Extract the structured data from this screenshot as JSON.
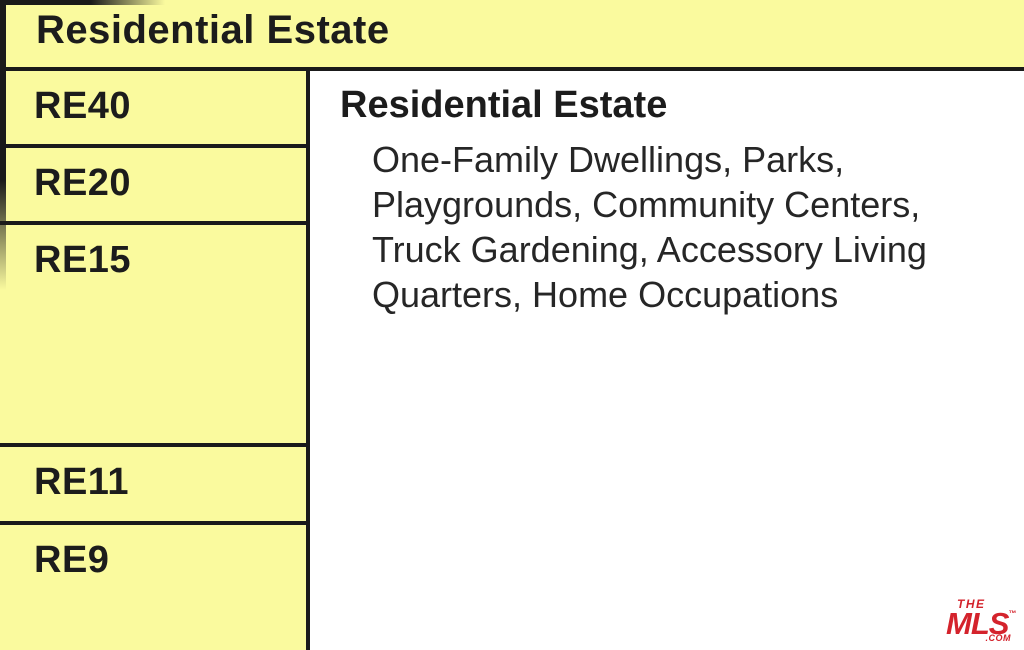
{
  "header": {
    "title": "Residential Estate"
  },
  "zones": {
    "codes": [
      "RE40",
      "RE20",
      "RE15",
      "RE11",
      "RE9"
    ]
  },
  "detail": {
    "heading": "Residential Estate",
    "description_lines": [
      "One-Family Dwellings, Parks,",
      "Playgrounds, Community Centers,",
      "Truck Gardening, Accessory Living",
      "Quarters, Home Occupations"
    ]
  },
  "logo": {
    "the": "THE",
    "mls": "MLS",
    "tm": "™",
    "com": ".COM"
  },
  "colors": {
    "cell_yellow": "#fafa9e",
    "border_black": "#1a1a1a",
    "text_black": "#1c1c1c",
    "logo_red": "#d4232c"
  }
}
